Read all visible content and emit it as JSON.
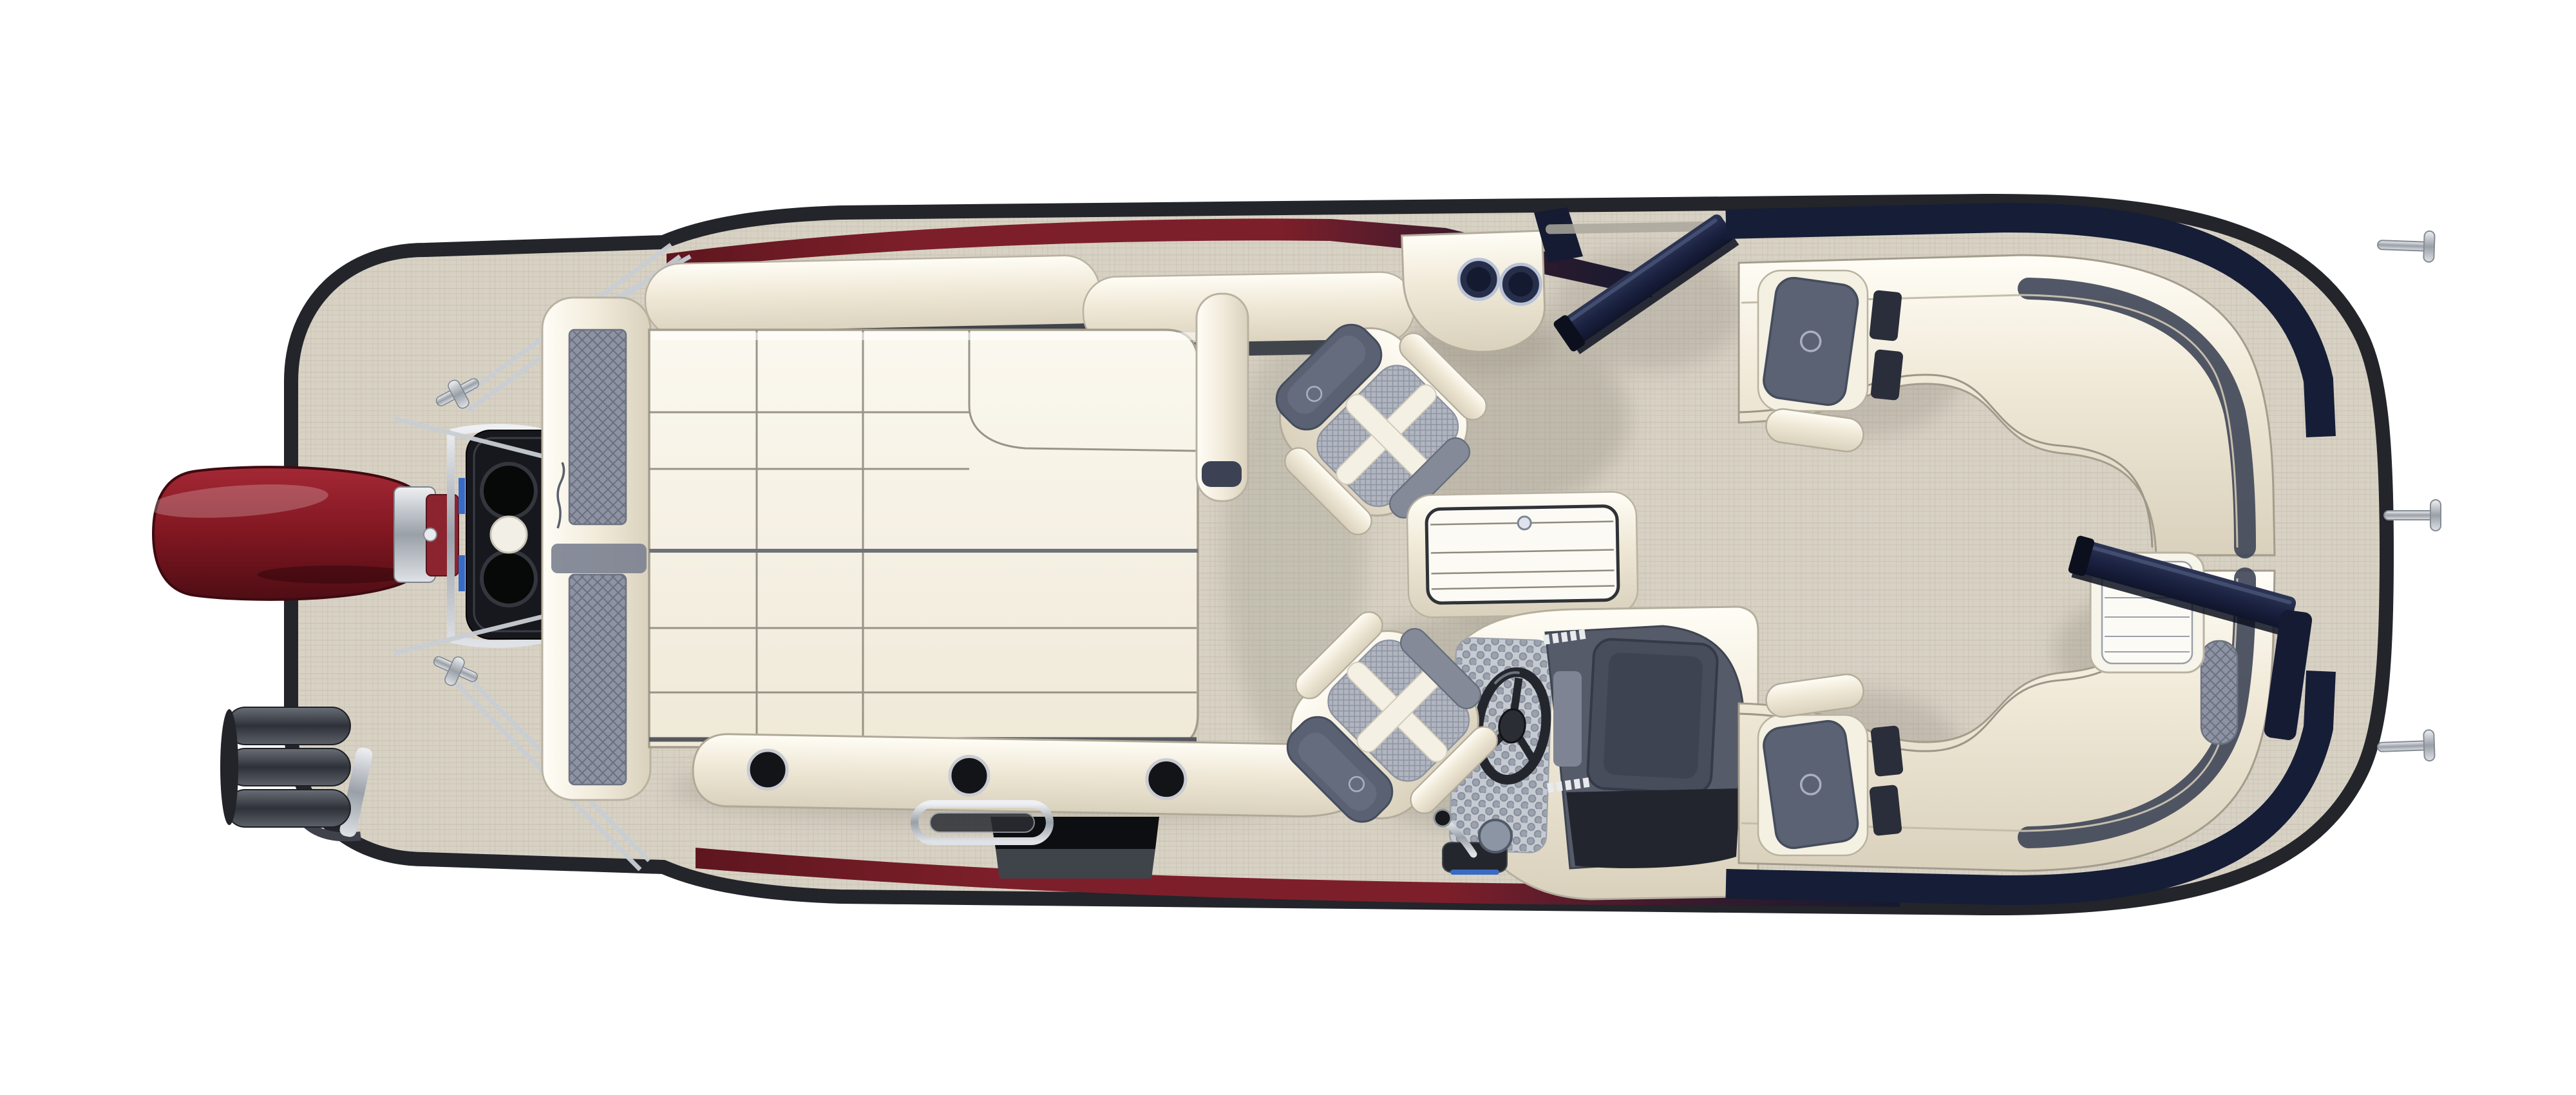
{
  "title": "Pontoon boat floorplan — overhead view",
  "palette": {
    "background": "#ffffff",
    "deck": "#d8d2c5",
    "deck_line": "#c8c1b2",
    "hull_outline": "#23252b",
    "navy": "#161d36",
    "navy_light": "#2a3150",
    "maroon": "#7d1f2a",
    "maroon_dark": "#5e161e",
    "ivory": "#f4efe1",
    "ivory_deep": "#e2dac5",
    "white": "#fcfaf4",
    "seam": "#9c968a",
    "mesh_gray": "#989eac",
    "mesh_dark": "#747b8a",
    "slate": "#596173",
    "dash_gray": "#555b69",
    "dash_dark": "#22252d",
    "black": "#0d0e11",
    "chrome": "#c9ced4",
    "chrome_dark": "#868c94",
    "motor_red": "#8c1f2b",
    "motor_red_dark": "#4f0d14",
    "shadow": "#7d7668",
    "accent_blue": "#3a6bc4"
  },
  "counts": {
    "aft_cupholders": 3,
    "console_cupholders": 2,
    "bow_cleats": 3,
    "captain_chairs": 2,
    "exhaust_ports": 2,
    "bow_lounges": 2
  },
  "components": {
    "hull": {
      "label": "Pontoon boat deck, overhead floorplan view"
    },
    "motor": {
      "label": "Red outboard motor at stern"
    },
    "motor_pod": {
      "label": "Engine pod with twin exhaust ports"
    },
    "rigging": {
      "label": "Stern rigging cables and chrome cleats"
    },
    "ladder": {
      "label": "Stowed boarding ladder rollers"
    },
    "tube_top": {
      "label": "Upper pontoon tube accent (red to navy)"
    },
    "tube_bottom": {
      "label": "Lower pontoon tube accent (red to navy)"
    },
    "step_pad": {
      "label": "Black boarding step pad"
    },
    "lounge": {
      "label": "Aft wraparound lounge with grid-stitched cushions"
    },
    "lounge_backrest": {
      "label": "Aft lounge backrest bolster"
    },
    "lounge_seatback": {
      "label": "Stern seatback with mesh panels"
    },
    "lounge_arm": {
      "label": "Lounge armrest bolster"
    },
    "lounge_base": {
      "label": "Lounge base rail with cup holders"
    },
    "cupholder": {
      "label": "Cup holder"
    },
    "grab_handle": {
      "label": "Chrome grab handle"
    },
    "chair_top": {
      "label": "Swivel captain chair, upper"
    },
    "chair_helm": {
      "label": "Helm captain chair"
    },
    "corner_console": {
      "label": "Corner console with two cup holders"
    },
    "side_gate": {
      "label": "Open side boarding gate"
    },
    "table": {
      "label": "Removable cocktail table"
    },
    "helm_console": {
      "label": "Helm console with dashboard"
    },
    "steering_wheel": {
      "label": "Steering wheel"
    },
    "throttle": {
      "label": "Throttle lever"
    },
    "helm_mat": {
      "label": "Helm honeycomb mat"
    },
    "bow_rail_top": {
      "label": "Upper bow rail (navy)"
    },
    "bow_rail_bottom": {
      "label": "Lower bow rail (navy)"
    },
    "bow_lounge_top": {
      "label": "Bow lounge, upper"
    },
    "bow_lounge_bottom": {
      "label": "Bow lounge, lower"
    },
    "headrest": {
      "label": "Lounge headrest pad"
    },
    "bow_hatch": {
      "label": "Bow step hatch with slats"
    },
    "bow_gate": {
      "label": "Open bow gate"
    },
    "cleat": {
      "label": "Mooring cleat"
    },
    "brand_logo": {
      "label": "Script brand logo"
    }
  }
}
